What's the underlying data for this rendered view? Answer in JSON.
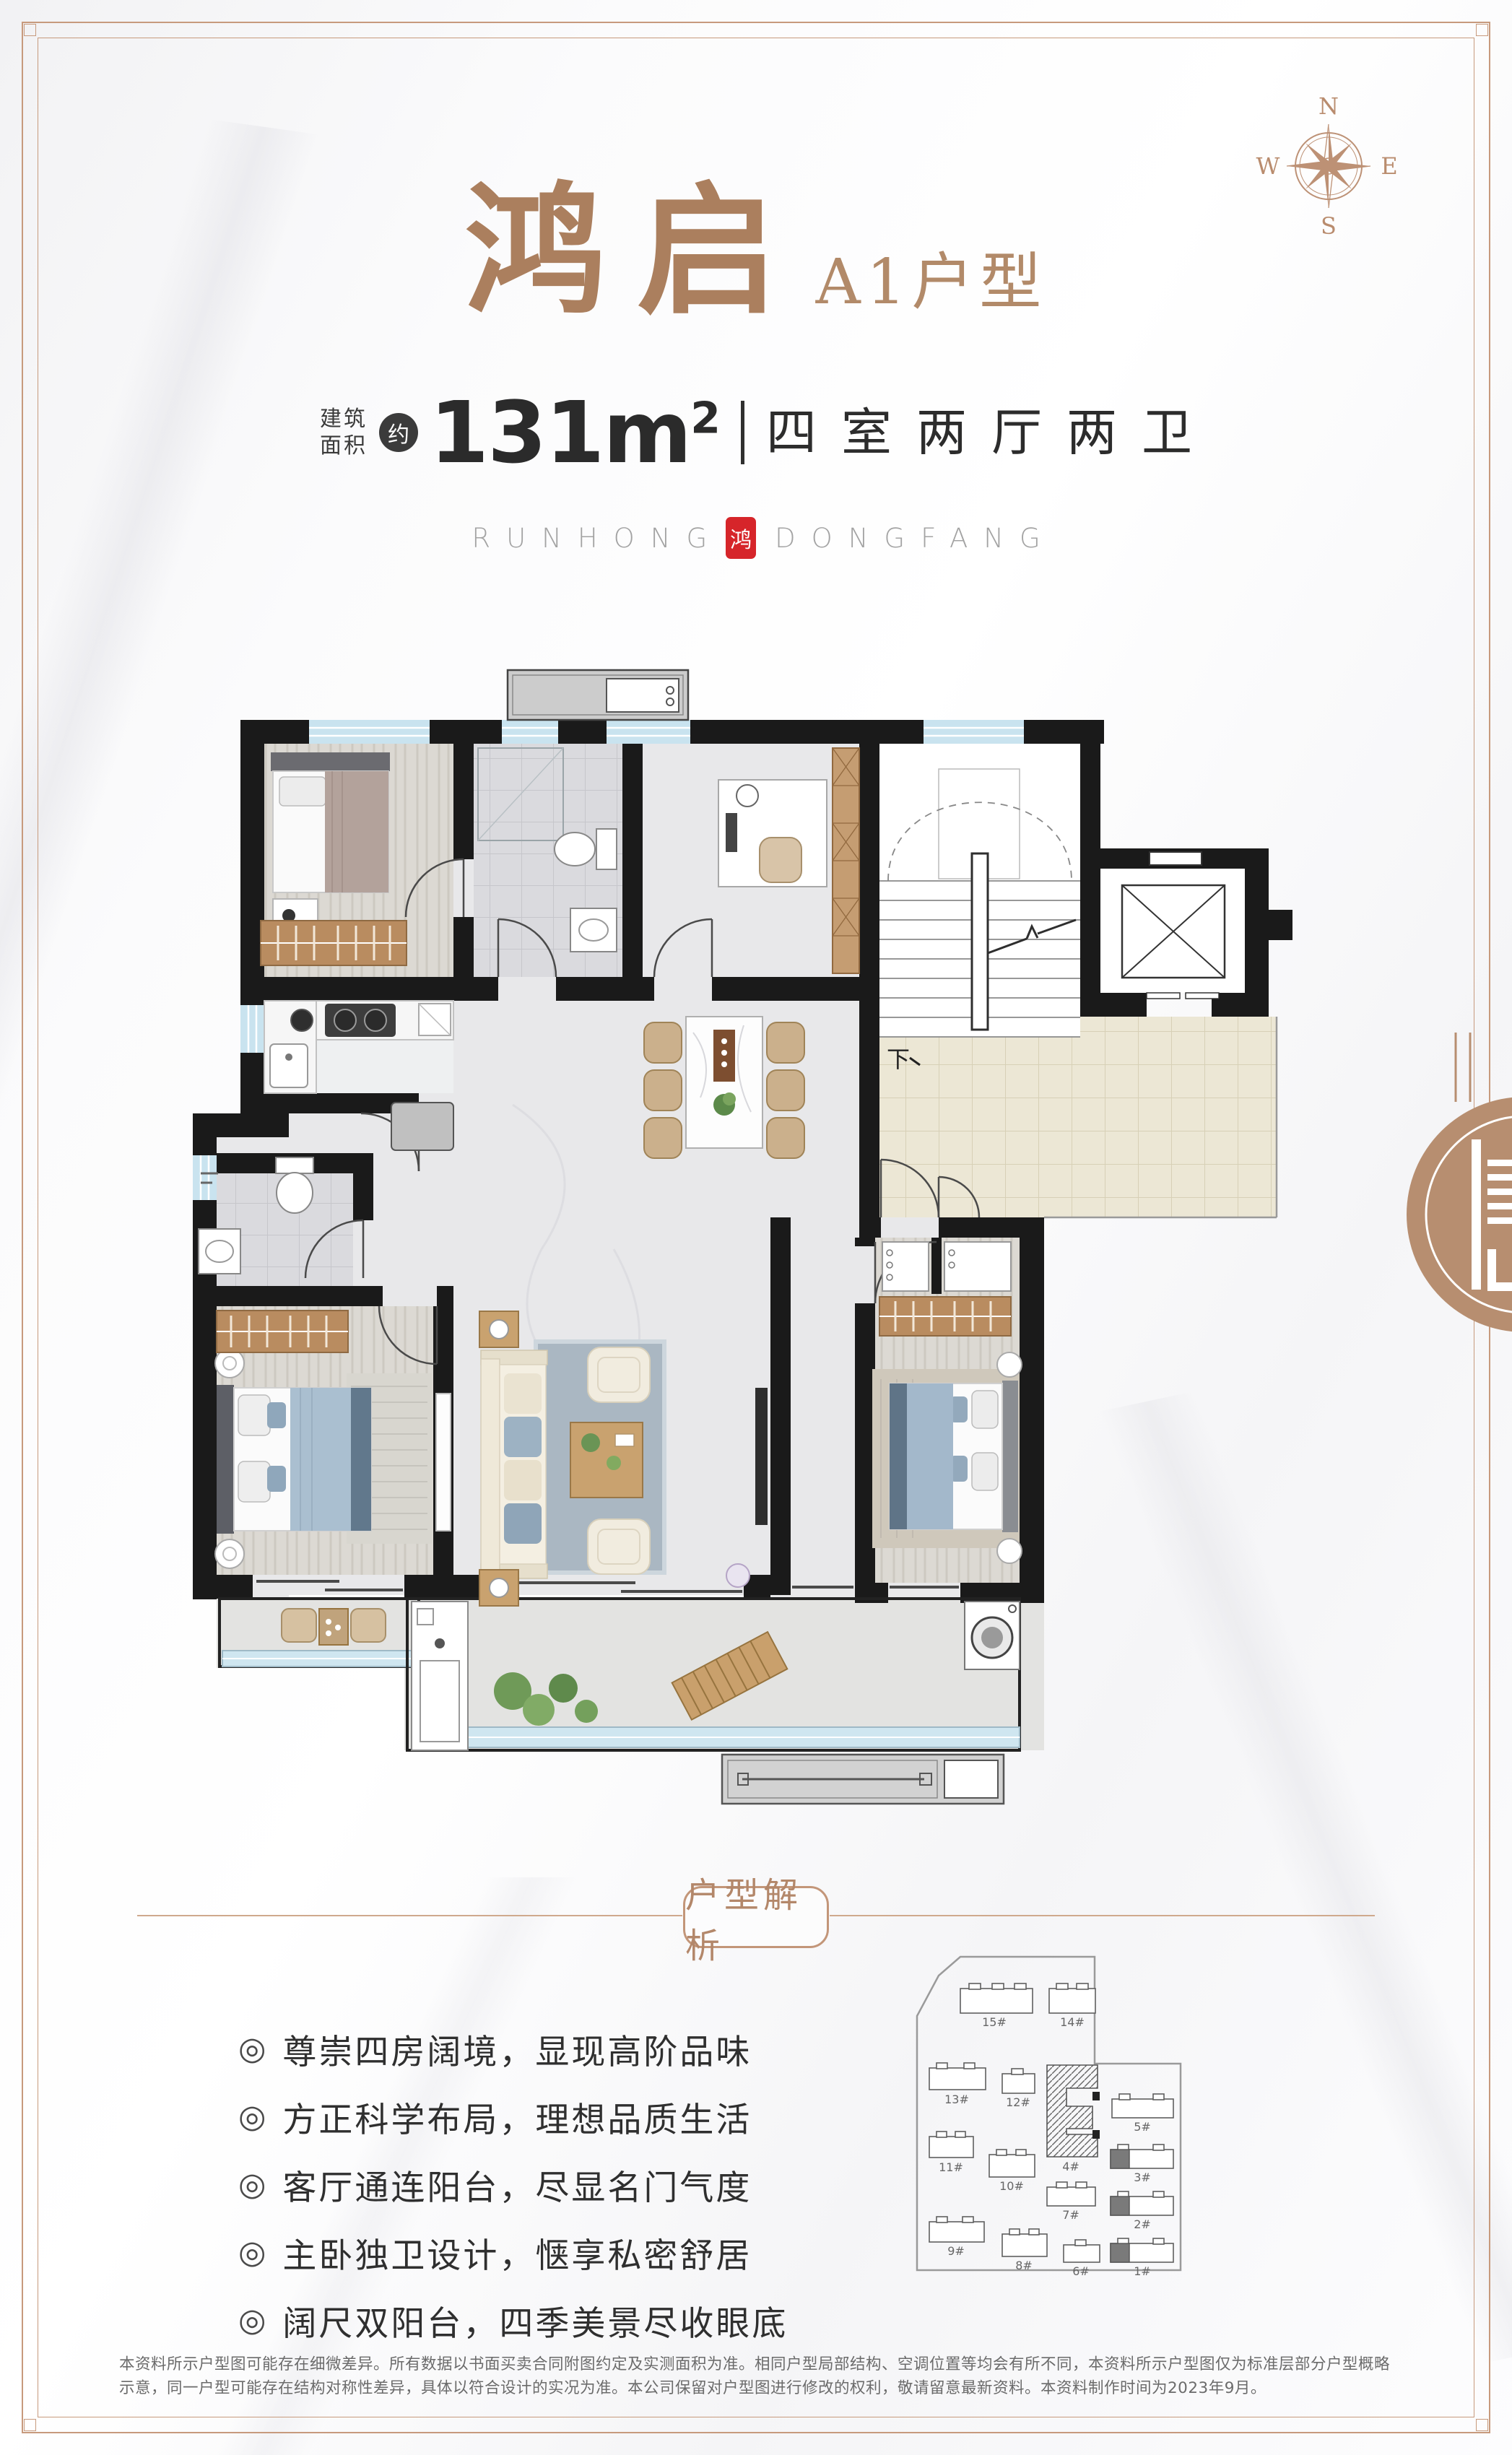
{
  "title": {
    "main": "鸿启",
    "sub": "A1户型"
  },
  "area": {
    "label_line1": "建筑",
    "label_line2": "面积",
    "approx": "约",
    "value": "131m",
    "sup": "2",
    "layout": "四室两厅两卫"
  },
  "brand": {
    "left": "RUNHONG",
    "seal": "鸿",
    "right": "DONGFANG"
  },
  "compass": {
    "n": "N",
    "e": "E",
    "s": "S",
    "w": "W"
  },
  "floorplan": {
    "stairs_down_label": "下"
  },
  "analysis": {
    "badge": "户型解析"
  },
  "features": {
    "bullet": "◎",
    "items": [
      "尊崇四房阔境，显现高阶品味",
      "方正科学布局，理想品质生活",
      "客厅通连阳台，尽显名门气度",
      "主卧独卫设计，惬享私密舒居",
      "阔尺双阳台，四季美景尽收眼底"
    ]
  },
  "site": {
    "buildings": [
      "15#",
      "14#",
      "13#",
      "12#",
      "4#",
      "5#",
      "11#",
      "10#",
      "3#",
      "7#",
      "2#",
      "9#",
      "8#",
      "6#",
      "1#"
    ]
  },
  "disclaimer": "本资料所示户型图可能存在细微差异。所有数据以书面买卖合同附图约定及实测面积为准。相同户型局部结构、空调位置等均会有所不同，本资料所示户型图仅为标准层部分户型概略示意，同一户型可能存在结构对称性差异，具体以符合设计的实况为准。本公司保留对户型图进行修改的权利，敬请留意最新资料。本资料制作时间为2023年9月。",
  "colors": {
    "accent_tan": "#b3876a",
    "title_tan": "#ab7f5e",
    "frame_tan": "#c79a7d",
    "seal_red": "#d6252a",
    "wall_black": "#1a1a1a",
    "window_blue": "#c9e3ef",
    "corridor_beige": "#ece7d5"
  }
}
